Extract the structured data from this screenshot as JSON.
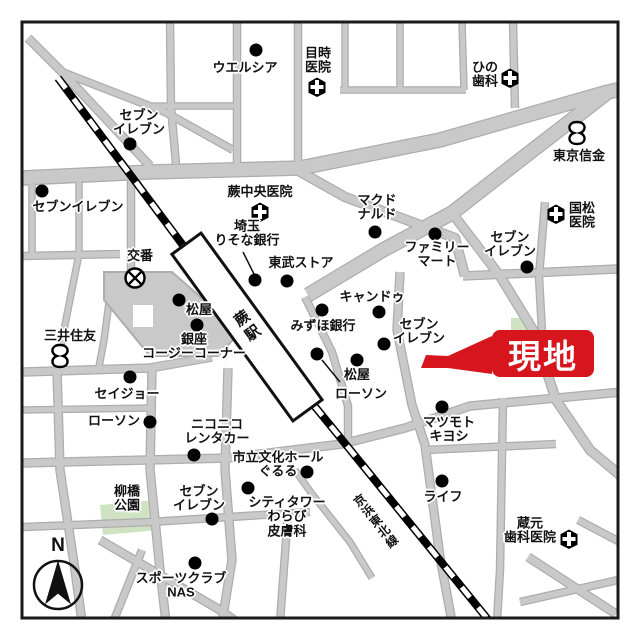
{
  "map": {
    "genchi": {
      "label": "現地",
      "box_color": "#d7151d",
      "text_color": "#ffffff"
    },
    "station": {
      "label": "蕨駅"
    },
    "railway": {
      "label": "京浜東北線"
    },
    "compass": {
      "label": "N"
    },
    "park_color": "#cfe3c2",
    "road_color": "#c9c9c9",
    "pois": [
      {
        "id": "welcia",
        "lines": [
          "ウエルシア"
        ],
        "icon": "dot"
      },
      {
        "id": "metoki-clinic",
        "lines": [
          "目時",
          "医院"
        ],
        "icon": "hospital"
      },
      {
        "id": "hino-dental",
        "lines": [
          "ひの",
          "歯科"
        ],
        "icon": "hospital"
      },
      {
        "id": "tokyo-shinkin-bank",
        "lines": [
          "東京信金"
        ],
        "icon": "bank"
      },
      {
        "id": "seven-eleven-north",
        "lines": [
          "セブン",
          "イレブン"
        ],
        "icon": "dot"
      },
      {
        "id": "seven-eleven-west",
        "lines": [
          "セブンイレブン"
        ],
        "icon": "dot"
      },
      {
        "id": "warabi-chuo-clinic",
        "lines": [
          "蕨中央医院"
        ],
        "icon": "hospital"
      },
      {
        "id": "mcdonalds",
        "lines": [
          "マクド",
          "ナルド"
        ],
        "icon": "dot"
      },
      {
        "id": "kunimatsu-clinic",
        "lines": [
          "国松",
          "医院"
        ],
        "icon": "hospital"
      },
      {
        "id": "saitama-resona-bank",
        "lines": [
          "埼玉",
          "りそな銀行"
        ],
        "icon": "dot"
      },
      {
        "id": "tobu-store",
        "lines": [
          "東武ストア"
        ],
        "icon": "dot"
      },
      {
        "id": "familymart",
        "lines": [
          "ファミリー",
          "マート"
        ],
        "icon": "dot"
      },
      {
        "id": "seven-eleven-east",
        "lines": [
          "セブン",
          "イレブン"
        ],
        "icon": "dot"
      },
      {
        "id": "cando",
        "lines": [
          "キャンドゥ"
        ],
        "icon": "dot"
      },
      {
        "id": "mizuho-bank",
        "lines": [
          "みずほ銀行"
        ],
        "icon": "dot"
      },
      {
        "id": "seven-eleven-center",
        "lines": [
          "セブン",
          "イレブン"
        ],
        "icon": "dot"
      },
      {
        "id": "matsuya-east",
        "lines": [
          "松屋"
        ],
        "icon": "dot"
      },
      {
        "id": "lawson-center",
        "lines": [
          "ローソン"
        ],
        "icon": "dot"
      },
      {
        "id": "matsuya-west",
        "lines": [
          "松屋"
        ],
        "icon": "dot"
      },
      {
        "id": "ginza-cozy-corner",
        "lines": [
          "銀座",
          "コージーコーナー"
        ],
        "icon": "dot"
      },
      {
        "id": "mitsui-sumitomo-bank",
        "lines": [
          "三井住友"
        ],
        "icon": "bank"
      },
      {
        "id": "koban",
        "lines": [
          "交番"
        ],
        "icon": "police"
      },
      {
        "id": "seijo",
        "lines": [
          "セイジョー"
        ],
        "icon": "dot"
      },
      {
        "id": "lawson-west",
        "lines": [
          "ローソン"
        ],
        "icon": "dot"
      },
      {
        "id": "niconico-rentacar",
        "lines": [
          "ニコニコ",
          "レンタカー"
        ],
        "icon": "dot"
      },
      {
        "id": "city-culture-hall-gururu",
        "lines": [
          "市立文化ホール",
          "ぐるる"
        ],
        "icon": "dot"
      },
      {
        "id": "city-tower-warabi-dermatology",
        "lines": [
          "シティタワー",
          "わらび",
          "皮膚科"
        ],
        "icon": "dot"
      },
      {
        "id": "seven-eleven-south",
        "lines": [
          "セブン",
          "イレブン"
        ],
        "icon": "dot"
      },
      {
        "id": "yanagibashi-park",
        "lines": [
          "柳橋",
          "公園"
        ],
        "icon": "none"
      },
      {
        "id": "sports-club-nas",
        "lines": [
          "スポーツクラブ",
          "NAS"
        ],
        "icon": "dot"
      },
      {
        "id": "matsumoto-kiyoshi",
        "lines": [
          "マツモト",
          "キヨシ"
        ],
        "icon": "dot"
      },
      {
        "id": "life-supermarket",
        "lines": [
          "ライフ"
        ],
        "icon": "dot"
      },
      {
        "id": "kuramoto-dental-clinic",
        "lines": [
          "蔵元",
          "歯科医院"
        ],
        "icon": "hospital"
      }
    ]
  }
}
